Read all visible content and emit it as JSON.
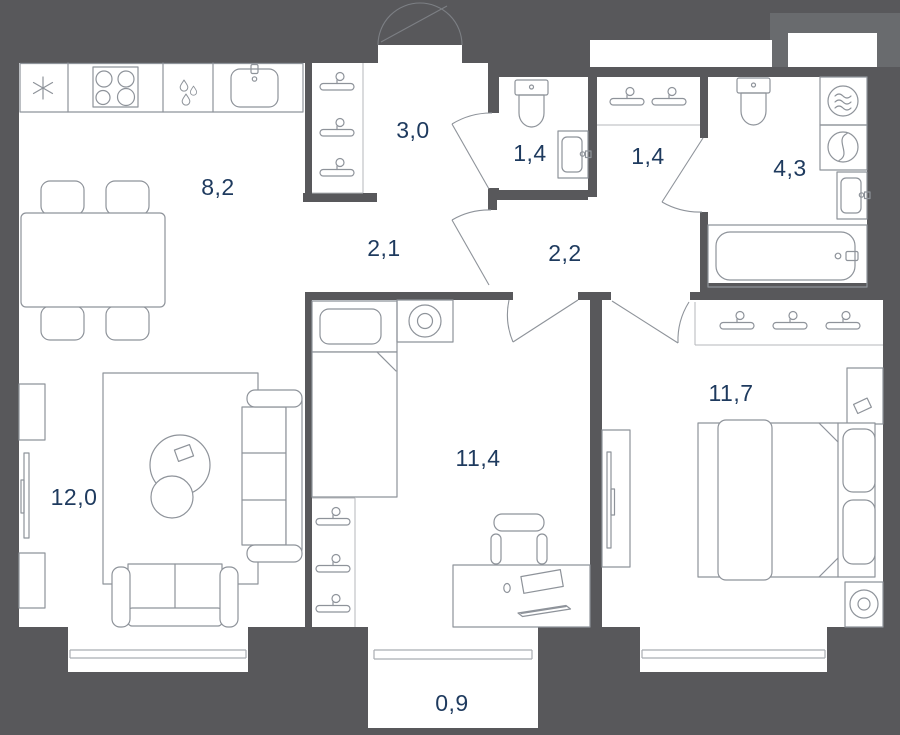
{
  "plan": {
    "type": "apartment-floor-plan",
    "colors": {
      "background": "#58585B",
      "room_fill": "#FFFFFF",
      "furniture_line": "#8E939A",
      "label_text": "#1E3A5E",
      "corner_patch": "#696B6E"
    },
    "rooms": {
      "kitchen": {
        "name": "kitchen-dining",
        "area": "8,2"
      },
      "hallway": {
        "name": "hallway-closet",
        "area": "3,0"
      },
      "wc": {
        "name": "wc",
        "area": "1,4"
      },
      "wardrobe_hall": {
        "name": "wardrobe-hall",
        "area": "1,4"
      },
      "bathroom": {
        "name": "bathroom",
        "area": "4,3"
      },
      "corridor": {
        "name": "corridor",
        "area": "2,1"
      },
      "entry_hall": {
        "name": "entry-hall",
        "area": "2,2"
      },
      "living": {
        "name": "living-room",
        "area": "12,0"
      },
      "bedroom_small": {
        "name": "bedroom-small",
        "area": "11,4"
      },
      "bedroom_master": {
        "name": "bedroom-master",
        "area": "11,7"
      },
      "balcony": {
        "name": "balcony",
        "area": "0,9"
      }
    }
  }
}
